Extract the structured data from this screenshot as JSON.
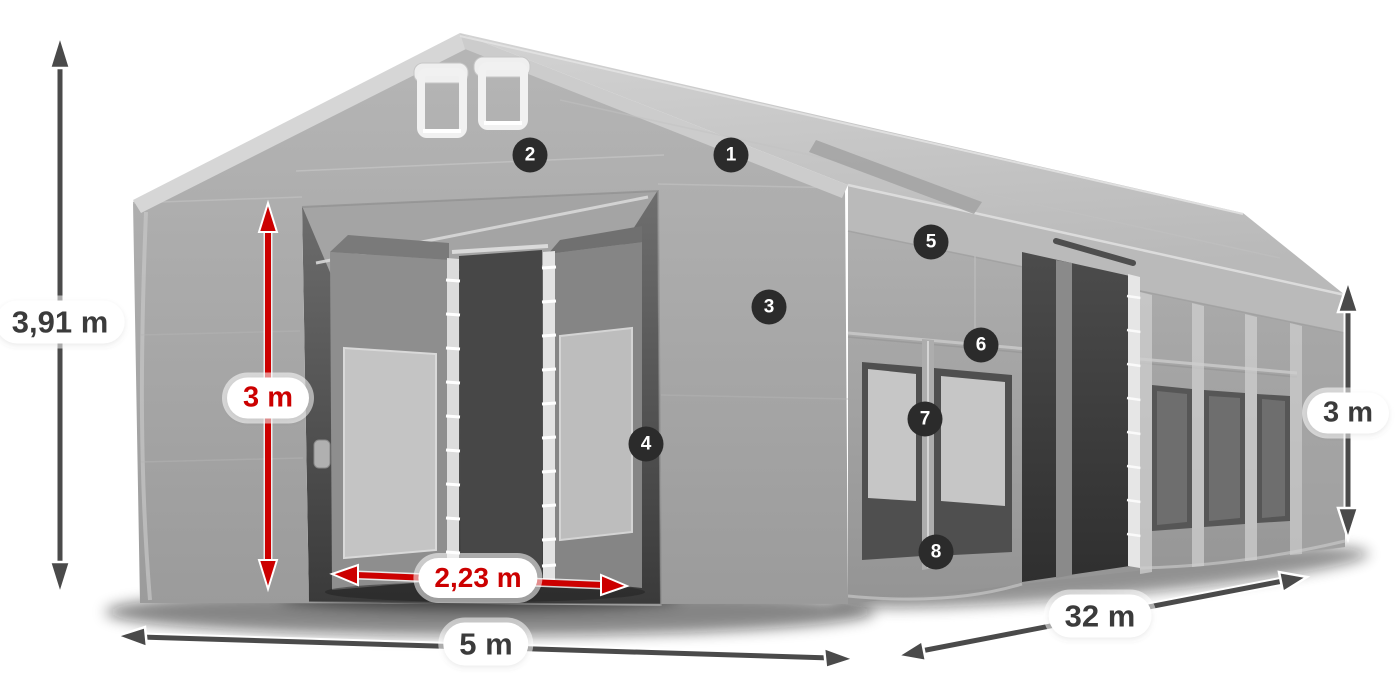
{
  "illustration": {
    "subject": "storage tent with dimension callouts",
    "colors": {
      "accent_red": "#cc0000",
      "arrow_dark": "#4a4a4a",
      "badge_background": "#2b2b2b",
      "badge_text": "#ffffff",
      "label_background": "#ffffff",
      "label_text_dark": "#3b3b3b",
      "tent_gray": "#a9a9a9"
    },
    "measurements": {
      "total_height": "3,91 m",
      "door_height": "3 m",
      "door_width": "2,23 m",
      "front_width": "5 m",
      "side_length": "32 m",
      "side_height": "3 m"
    },
    "markers": [
      "1",
      "2",
      "3",
      "4",
      "5",
      "6",
      "7",
      "8"
    ]
  }
}
